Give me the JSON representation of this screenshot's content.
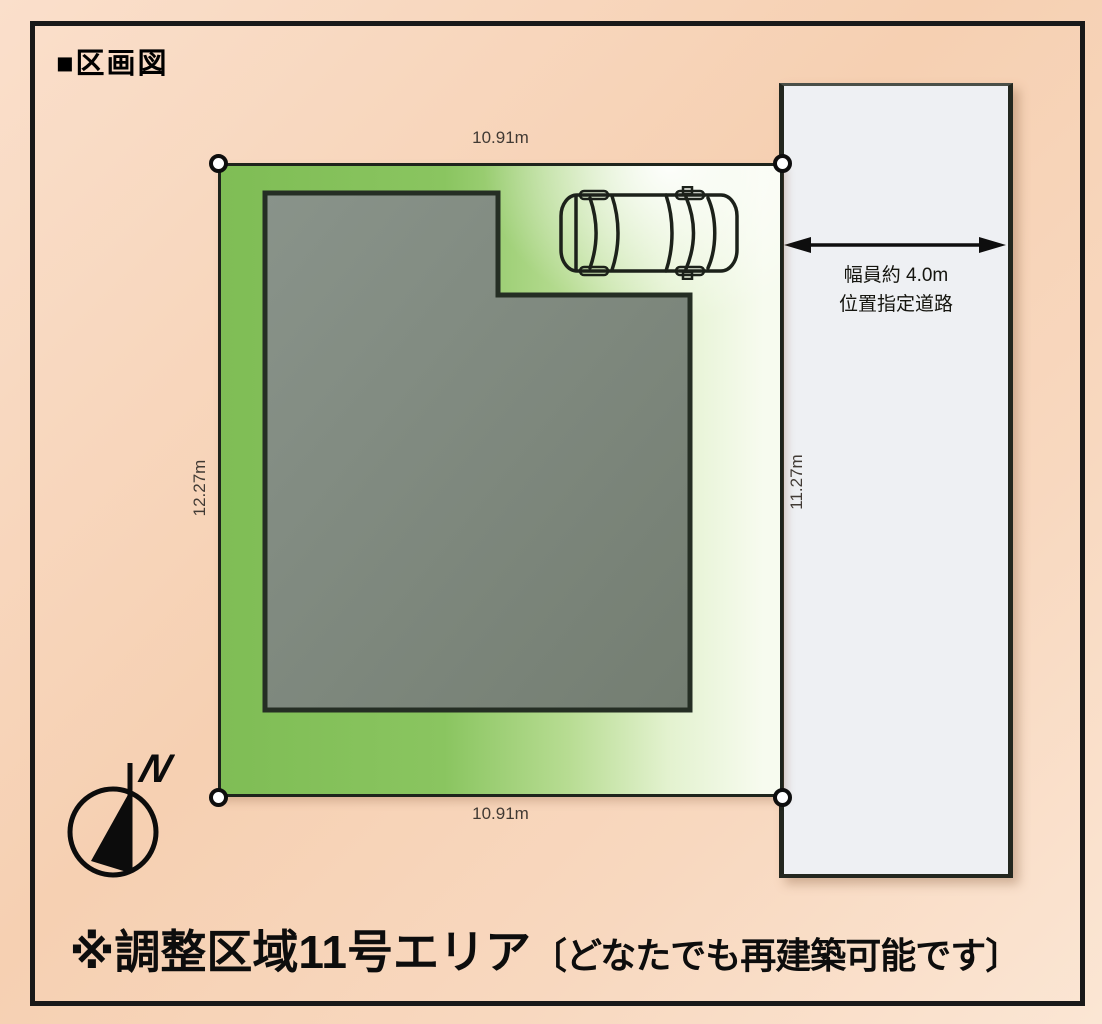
{
  "title": "■区画図",
  "plot": {
    "dim_top": "10.91m",
    "dim_bottom": "10.91m",
    "dim_left": "12.27m",
    "dim_right": "11.27m"
  },
  "road": {
    "width_label": "幅員約 4.0m",
    "type_label": "位置指定道路"
  },
  "compass": {
    "north_label": "N"
  },
  "footer": {
    "area_text": "※調整区域11号エリア",
    "note_text": "〔どなたでも再建築可能です〕"
  },
  "colors": {
    "background_peach": "#f8d7bd",
    "plot_green": "#85c25b",
    "plot_fade": "#f7fbef",
    "building_gray": "#7b857a",
    "road_gray": "#eef0f3",
    "line_black": "#1a1a1a",
    "marker_white": "#ffffff"
  }
}
